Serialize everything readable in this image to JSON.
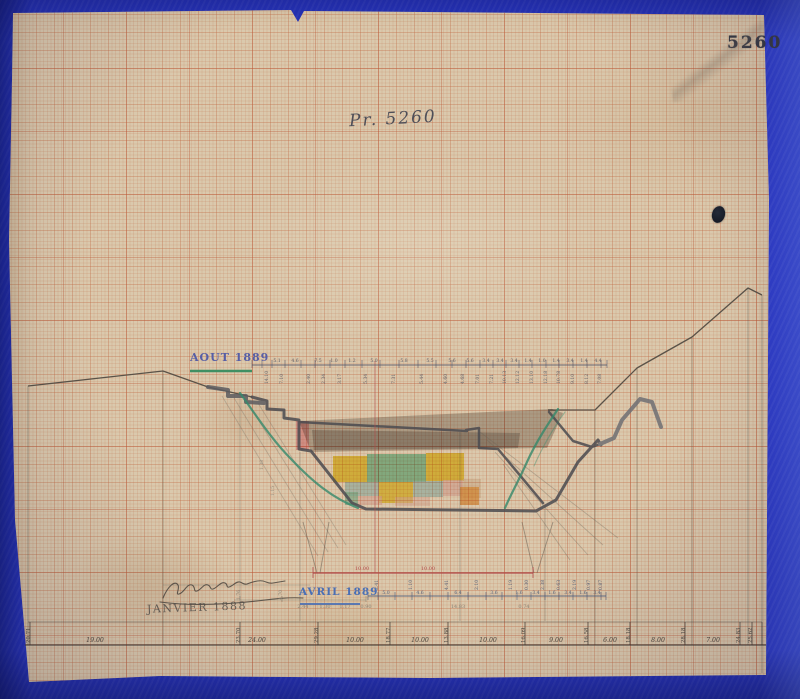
{
  "document": {
    "stamp_number": "5260",
    "handwritten_title": "Pr. 5260",
    "survey_labels": {
      "aout": "AOUT 1889",
      "avril": "AVRIL 1889",
      "janvier": "JANVIER 1888"
    }
  },
  "colors": {
    "paper": "#dac9ad",
    "grid_heavy": "#ba5434",
    "background_blue": "#2a37c4",
    "ink_dark": "#4a4a50",
    "ink_blue_label": "#565ea6",
    "ink_avril_blue": "#4a6fb5",
    "underline_green": "#3f8f63",
    "red_axis": "#b24d4d",
    "fill_yellow": "#f0d53a",
    "fill_seafoam": "#7ecba6",
    "fill_cyan": "#a9d6e4",
    "fill_pink": "#ef9fb0",
    "fill_light_pink": "#f2cdd3",
    "fill_orange": "#f2a94f",
    "fill_gray": "#98948e"
  },
  "tick_sets": [
    {
      "name": "aout-ticks",
      "y1": 360,
      "y2": 368,
      "color": "rgba(86,86,104,.8)",
      "w": 0.7,
      "xs": [
        252,
        262,
        272,
        285,
        301,
        315,
        330,
        345,
        362,
        380,
        399,
        418,
        436,
        452,
        466,
        480,
        493,
        506,
        519,
        532,
        546,
        559,
        573,
        587,
        601,
        607
      ]
    },
    {
      "name": "avril-ticks",
      "y1": 592,
      "y2": 600,
      "color": "rgba(77,90,120,.8)",
      "w": 0.7,
      "xs": [
        368,
        378,
        395,
        412,
        430,
        448,
        468,
        486,
        502,
        517,
        531,
        545,
        559,
        573,
        587,
        601,
        606
      ]
    },
    {
      "name": "janvier-ticks",
      "y1": 596,
      "y2": 602,
      "color": "rgba(90,85,75,.5)",
      "w": 0.7,
      "xs": [
        240,
        282,
        366
      ]
    },
    {
      "name": "bottom-ticks",
      "y1": 622,
      "y2": 645,
      "color": "rgba(60,56,50,.75)",
      "w": 0.9,
      "xs": [
        30,
        240,
        318,
        390,
        448,
        525,
        588,
        630,
        685,
        740,
        752,
        762
      ]
    }
  ],
  "label_sets": [
    {
      "name": "aout-top-numbers",
      "y": 362,
      "size": 4.6,
      "color": "#5f5f68",
      "rot": false,
      "items": [
        {
          "x": 277,
          "t": "5.1"
        },
        {
          "x": 295,
          "t": "4.6"
        },
        {
          "x": 318,
          "t": "7.5"
        },
        {
          "x": 334,
          "t": "1.0"
        },
        {
          "x": 352,
          "t": "1.2"
        },
        {
          "x": 374,
          "t": "5.0"
        },
        {
          "x": 404,
          "t": "5.8"
        },
        {
          "x": 430,
          "t": "5.5"
        },
        {
          "x": 452,
          "t": "5.6"
        },
        {
          "x": 470,
          "t": "5.6"
        },
        {
          "x": 486,
          "t": "3.4"
        },
        {
          "x": 500,
          "t": "3.4"
        },
        {
          "x": 514,
          "t": "3.4"
        },
        {
          "x": 528,
          "t": "1.4"
        },
        {
          "x": 542,
          "t": "1.0"
        },
        {
          "x": 556,
          "t": "1.4"
        },
        {
          "x": 570,
          "t": "3.4"
        },
        {
          "x": 584,
          "t": "1.4"
        },
        {
          "x": 598,
          "t": "4.4"
        }
      ]
    },
    {
      "name": "aout-rotated-numbers",
      "y": 384,
      "size": 4.6,
      "color": "#5f5f68",
      "rot": true,
      "items": [
        {
          "x": 268,
          "t": "14.10"
        },
        {
          "x": 283,
          "t": "7.10"
        },
        {
          "x": 310,
          "t": "2.40"
        },
        {
          "x": 325,
          "t": "2.34"
        },
        {
          "x": 341,
          "t": "3.17"
        },
        {
          "x": 367,
          "t": "5.34"
        },
        {
          "x": 395,
          "t": "7.31"
        },
        {
          "x": 423,
          "t": "5.44"
        },
        {
          "x": 447,
          "t": "4.60"
        },
        {
          "x": 464,
          "t": "4.68"
        },
        {
          "x": 479,
          "t": "7.01"
        },
        {
          "x": 493,
          "t": "7.21"
        },
        {
          "x": 506,
          "t": "10.13"
        },
        {
          "x": 519,
          "t": "12.12"
        },
        {
          "x": 533,
          "t": "13.10"
        },
        {
          "x": 547,
          "t": "12.18"
        },
        {
          "x": 560,
          "t": "10.78"
        },
        {
          "x": 574,
          "t": "9.10"
        },
        {
          "x": 588,
          "t": "8.12"
        },
        {
          "x": 601,
          "t": "7.08"
        }
      ]
    },
    {
      "name": "avril-rotated-numbers",
      "y": 590,
      "size": 4.6,
      "color": "#5a6278",
      "rot": true,
      "items": [
        {
          "x": 378,
          "t": "2.41"
        },
        {
          "x": 412,
          "t": "1.10"
        },
        {
          "x": 448,
          "t": "4.41"
        },
        {
          "x": 478,
          "t": "2.10"
        },
        {
          "x": 512,
          "t": "1.19"
        },
        {
          "x": 528,
          "t": "0.30"
        },
        {
          "x": 544,
          "t": "2.38"
        },
        {
          "x": 560,
          "t": "0.63"
        },
        {
          "x": 576,
          "t": "2.19"
        },
        {
          "x": 590,
          "t": "0.97"
        },
        {
          "x": 602,
          "t": "0.87"
        }
      ]
    },
    {
      "name": "avril-segment-numbers",
      "y": 594,
      "size": 4.6,
      "color": "#5a6278",
      "rot": false,
      "items": [
        {
          "x": 386,
          "t": "5.0"
        },
        {
          "x": 420,
          "t": "4.6"
        },
        {
          "x": 458,
          "t": "6.4"
        },
        {
          "x": 494,
          "t": "3.6"
        },
        {
          "x": 519,
          "t": "1.6"
        },
        {
          "x": 536,
          "t": "3.4"
        },
        {
          "x": 552,
          "t": "1.6"
        },
        {
          "x": 568,
          "t": "3.4"
        },
        {
          "x": 583,
          "t": "1.6"
        },
        {
          "x": 597,
          "t": "3.4"
        }
      ]
    },
    {
      "name": "janvier-pencil-numbers",
      "y": 608,
      "size": 5,
      "color": "#8d8375",
      "rot": false,
      "items": [
        {
          "x": 303,
          "t": "2.44"
        },
        {
          "x": 325,
          "t": "1.30"
        },
        {
          "x": 345,
          "t": "1.17"
        },
        {
          "x": 366,
          "t": "0.90"
        },
        {
          "x": 458,
          "t": "14.83"
        },
        {
          "x": 524,
          "t": "0.74"
        }
      ]
    },
    {
      "name": "janvier-rotated-numbers",
      "y": 600,
      "size": 4.6,
      "color": "#8d8375",
      "rot": true,
      "items": [
        {
          "x": 240,
          "t": "1.76"
        },
        {
          "x": 282,
          "t": "4.70"
        }
      ]
    },
    {
      "name": "slope-pencil-numbers",
      "y": 470,
      "size": 4.6,
      "color": "#968b7c",
      "rot": true,
      "items": [
        {
          "x": 263,
          "t": "1.38"
        },
        {
          "x": 274,
          "y": 496,
          "t": "1.15"
        }
      ]
    },
    {
      "name": "bottom-rotated-elevations",
      "y": 643,
      "size": 5.4,
      "color": "#4c463e",
      "rot": true,
      "items": [
        {
          "x": 30,
          "t": "20.71"
        },
        {
          "x": 240,
          "t": "23.70"
        },
        {
          "x": 318,
          "t": "29.28"
        },
        {
          "x": 390,
          "t": "18.77"
        },
        {
          "x": 448,
          "t": "13.88"
        },
        {
          "x": 525,
          "t": "16.09"
        },
        {
          "x": 588,
          "t": "16.58"
        },
        {
          "x": 630,
          "t": "18.18"
        },
        {
          "x": 685,
          "t": "28.18"
        },
        {
          "x": 740,
          "t": "24.83"
        },
        {
          "x": 752,
          "t": "25.62"
        }
      ]
    },
    {
      "name": "bottom-distance-numbers",
      "y": 642,
      "size": 6.2,
      "color": "#4c463e",
      "rot": false,
      "italic": true,
      "items": [
        {
          "x": 95,
          "t": "19.00"
        },
        {
          "x": 257,
          "t": "24.00"
        },
        {
          "x": 355,
          "t": "10.00"
        },
        {
          "x": 420,
          "t": "10.00"
        },
        {
          "x": 488,
          "t": "10.00"
        },
        {
          "x": 556,
          "t": "9.00"
        },
        {
          "x": 610,
          "t": "6.00"
        },
        {
          "x": 658,
          "t": "8.00"
        },
        {
          "x": 713,
          "t": "7.00"
        }
      ]
    },
    {
      "name": "red-dimension-numbers",
      "y": 570,
      "size": 5,
      "color": "#b24d4d",
      "rot": false,
      "items": [
        {
          "x": 362,
          "t": "10.00"
        },
        {
          "x": 428,
          "t": "10.00"
        }
      ]
    }
  ]
}
